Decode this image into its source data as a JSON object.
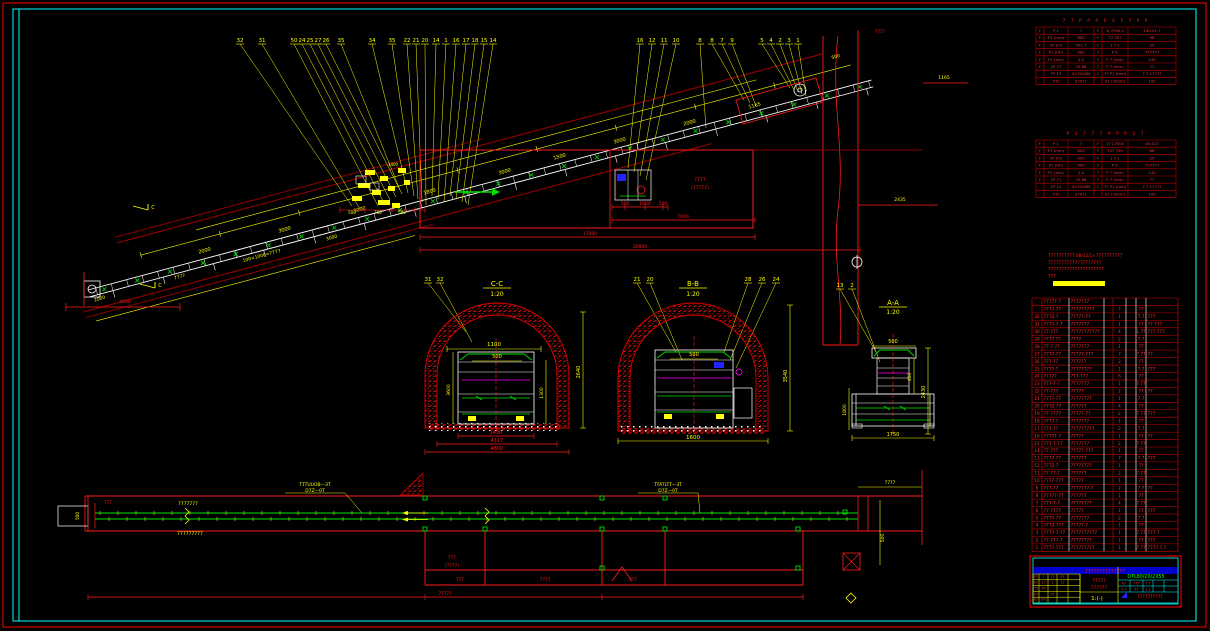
{
  "drawing": {
    "model": "DTL80/20/2X55",
    "type": "belt-conveyor-installation-drawing"
  },
  "elevation": {
    "callouts": [
      {
        "n": "32",
        "x": 240,
        "tx": 352,
        "ty": 206
      },
      {
        "n": "31",
        "x": 262,
        "tx": 360,
        "ty": 209
      },
      {
        "n": "50",
        "x": 294,
        "tx": 378,
        "ty": 206
      },
      {
        "n": "24",
        "x": 302,
        "tx": 384,
        "ty": 203
      },
      {
        "n": "25",
        "x": 310,
        "tx": 390,
        "ty": 200
      },
      {
        "n": "27",
        "x": 318,
        "tx": 396,
        "ty": 197
      },
      {
        "n": "26",
        "x": 326,
        "tx": 402,
        "ty": 194
      },
      {
        "n": "35",
        "x": 341,
        "tx": 400,
        "ty": 190
      },
      {
        "n": "34",
        "x": 372,
        "tx": 408,
        "ty": 193
      },
      {
        "n": "35",
        "x": 392,
        "tx": 414,
        "ty": 196
      },
      {
        "n": "22",
        "x": 407,
        "tx": 418,
        "ty": 199
      },
      {
        "n": "21",
        "x": 416,
        "tx": 422,
        "ty": 202
      },
      {
        "n": "20",
        "x": 425,
        "tx": 426,
        "ty": 205
      },
      {
        "n": "14",
        "x": 436,
        "tx": 432,
        "ty": 196
      },
      {
        "n": "1",
        "x": 446,
        "tx": 438,
        "ty": 199
      },
      {
        "n": "16",
        "x": 456,
        "tx": 444,
        "ty": 202
      },
      {
        "n": "17",
        "x": 466,
        "tx": 450,
        "ty": 196
      },
      {
        "n": "18",
        "x": 475,
        "tx": 456,
        "ty": 199
      },
      {
        "n": "15",
        "x": 484,
        "tx": 462,
        "ty": 202
      },
      {
        "n": "14",
        "x": 493,
        "tx": 468,
        "ty": 205
      },
      {
        "n": "16",
        "x": 640,
        "tx": 628,
        "ty": 168
      },
      {
        "n": "12",
        "x": 652,
        "tx": 634,
        "ty": 172
      },
      {
        "n": "11",
        "x": 664,
        "tx": 640,
        "ty": 176
      },
      {
        "n": "10",
        "x": 676,
        "tx": 646,
        "ty": 180
      },
      {
        "n": "8",
        "x": 700,
        "tx": 706,
        "ty": 128
      },
      {
        "n": "8",
        "x": 712,
        "tx": 744,
        "ty": 100
      },
      {
        "n": "7",
        "x": 722,
        "tx": 750,
        "ty": 103
      },
      {
        "n": "9",
        "x": 732,
        "tx": 756,
        "ty": 106
      },
      {
        "n": "5",
        "x": 762,
        "tx": 790,
        "ty": 88
      },
      {
        "n": "4",
        "x": 771,
        "tx": 794,
        "ty": 90
      },
      {
        "n": "2",
        "x": 780,
        "tx": 798,
        "ty": 92
      },
      {
        "n": "3",
        "x": 789,
        "tx": 802,
        "ty": 94
      },
      {
        "n": "1",
        "x": 798,
        "tx": 806,
        "ty": 96
      }
    ],
    "incline_dims": [
      {
        "t": "2000",
        "x": 205,
        "y": 252
      },
      {
        "t": "3000",
        "x": 285,
        "y": 231
      },
      {
        "t": "3000",
        "x": 360,
        "y": 211
      },
      {
        "t": "1800",
        "x": 430,
        "y": 193
      },
      {
        "t": "3000",
        "x": 505,
        "y": 173
      },
      {
        "t": "1500",
        "x": 560,
        "y": 158
      },
      {
        "t": "3000",
        "x": 620,
        "y": 142
      },
      {
        "t": "2000",
        "x": 690,
        "y": 124
      },
      {
        "t": "1165",
        "x": 755,
        "y": 107
      }
    ],
    "tail_dims": [
      {
        "t": "2000",
        "x": 100,
        "y": 300
      },
      {
        "t": "7777",
        "x": 180,
        "y": 278
      },
      {
        "t": "100×1000=7777",
        "x": 262,
        "y": 257
      },
      {
        "t": "3000",
        "x": 332,
        "y": 239
      }
    ],
    "cluster_dims": [
      {
        "t": "500",
        "x": 352,
        "y": 214
      },
      {
        "t": "700",
        "x": 378,
        "y": 214
      },
      {
        "t": "500",
        "x": 402,
        "y": 214
      },
      {
        "t": "1400",
        "x": 393,
        "y": 166
      }
    ],
    "red_dims": [
      {
        "t": "500",
        "x": 625,
        "y": 205
      },
      {
        "t": "1000",
        "x": 645,
        "y": 205
      },
      {
        "t": "500",
        "x": 663,
        "y": 205
      },
      {
        "t": "7000",
        "x": 683,
        "y": 218
      },
      {
        "t": "17000",
        "x": 590,
        "y": 235
      },
      {
        "t": "30000",
        "x": 640,
        "y": 248
      },
      {
        "t": "4000",
        "x": 125,
        "y": 303
      }
    ],
    "room_label": [
      "7777",
      "(77777)"
    ],
    "head_texts": {
      "t1": "1165",
      "t2": "2435",
      "t3": "7777",
      "t4": "500"
    },
    "cut_label": "C"
  },
  "sections": {
    "cc": {
      "title": "C-C",
      "scale": "1:20",
      "callouts": [
        {
          "n": "31",
          "x": 428,
          "tx": 466,
          "ty": 332
        },
        {
          "n": "32",
          "x": 440,
          "tx": 472,
          "ty": 342
        }
      ],
      "top_dim": "1100",
      "top_dim2": "500",
      "right_dim": "2640",
      "left_dim": "3600",
      "inner_dim": "1300",
      "bottom_dims": [
        "1430",
        "4117",
        "4800"
      ]
    },
    "bb": {
      "title": "B-B",
      "scale": "1:20",
      "callouts": [
        {
          "n": "21",
          "x": 637,
          "tx": 676,
          "ty": 352
        },
        {
          "n": "20",
          "x": 650,
          "tx": 682,
          "ty": 360
        },
        {
          "n": "28",
          "x": 748,
          "tx": 724,
          "ty": 352
        },
        {
          "n": "26",
          "x": 762,
          "tx": 730,
          "ty": 360
        },
        {
          "n": "24",
          "x": 776,
          "tx": 736,
          "ty": 368
        }
      ],
      "top_dim": "500",
      "bottom_dim": "1600",
      "right_dim": "3540"
    },
    "aa": {
      "title": "A-A",
      "scale": "1:20",
      "callouts": [
        {
          "n": "13",
          "x": 840,
          "tx": 876,
          "ty": 352
        },
        {
          "n": "2",
          "x": 852,
          "tx": 880,
          "ty": 362
        }
      ],
      "top_dim": "500",
      "right_dim": "2430",
      "inner_dim": "400",
      "left_dim": "1800",
      "bottom_dim": "1750"
    }
  },
  "plan": {
    "label_above": "7777777",
    "label_below": "777777777",
    "callout1": [
      "TTTUUOB—3T",
      "D7Z—0T"
    ],
    "callout2": [
      "TTATLTT—3T",
      "D7Z—0T"
    ],
    "room_label": [
      "777",
      "(7777)"
    ],
    "dim_texts": [
      {
        "t": "777",
        "x": 460,
        "y": 581
      },
      {
        "t": "7777",
        "x": 545,
        "y": 581
      },
      {
        "t": "777",
        "x": 633,
        "y": 581
      },
      {
        "t": "77777",
        "x": 445,
        "y": 595
      }
    ],
    "left_dim": "500",
    "left_text": "777",
    "right_dim": "500",
    "right_top_dim": "7777"
  },
  "spec_table_1": {
    "header": "7 7 P P P E 3 7 7 P P",
    "rows": [
      [
        "F",
        "P 1",
        "7",
        "F",
        "1J 7000-1",
        "100-01.7"
      ],
      [
        "F",
        "P1 (mm)",
        "800",
        "F",
        "77 307",
        "98"
      ],
      [
        "F",
        "1P (m)",
        "452.7",
        "F",
        "1 7 1",
        "25"
      ],
      [
        "F",
        "P1 (t/h)",
        "400",
        "7",
        "P E",
        "777777"
      ],
      [
        "F",
        "P1 (m/s)",
        "2.0",
        "7",
        "P 7 (mm)",
        "140"
      ],
      [
        "F",
        "1P (°)",
        "25.88",
        "7",
        "P 7 (mm)",
        "77"
      ],
      [
        "",
        "TP 13",
        "2×Y200M",
        "1",
        "77 P1 (mm)",
        "7 7 17777"
      ],
      [
        "",
        "-T71",
        "S7071",
        "",
        "21 (7/mm)",
        "100"
      ]
    ]
  },
  "spec_table_2": {
    "header": "P 3 7 7 7 P P P 3 7",
    "rows": [
      [
        "F",
        "P 1",
        "7",
        "F",
        "17 J-7000",
        "45-017"
      ],
      [
        "F",
        "P1 (mm)",
        "800",
        "F",
        "707 700",
        "88"
      ],
      [
        "F",
        "1P (m)",
        "320",
        "F",
        "1 7 1",
        "25"
      ],
      [
        "F",
        "P1 (t/h)",
        "400",
        "7",
        "P E",
        "777777"
      ],
      [
        "F",
        "P1 (m/s)",
        "2.0",
        "7",
        "P 7 (mm)",
        "140"
      ],
      [
        "F",
        "1P (°)",
        "25.88",
        "7",
        "P 7 (mm)",
        "77"
      ],
      [
        "",
        "TP 13",
        "2×Y200M",
        "1",
        "77 P1 (mm)",
        "7 7 17777"
      ],
      [
        "",
        "-T71",
        "S7071",
        "",
        "21 (7/mm)",
        "100"
      ]
    ]
  },
  "notes": {
    "lines": [
      "7777777777 0B/12/2×7777777777",
      "77777777777777777777",
      "777777777777777777777",
      "777"
    ]
  },
  "bom": {
    "rows": [
      [
        "",
        "77777-7",
        "7777777",
        "",
        "",
        "",
        "",
        ""
      ],
      [
        "",
        "7777-77",
        "777777777",
        "",
        "7",
        "",
        "77",
        ""
      ],
      [
        "32",
        "777Z-7",
        "77777-77",
        "",
        "1",
        "",
        "7.7",
        "777"
      ],
      [
        "31",
        "7777-7-7",
        "7777777",
        "",
        "1",
        "",
        "77",
        "77 777"
      ],
      [
        "30",
        "77-777",
        "77777777777",
        "",
        "4",
        "",
        "1.77",
        "777 777"
      ],
      [
        "29",
        "7777.77",
        "7777",
        "",
        "2",
        "",
        "7.7",
        ""
      ],
      [
        "28",
        "77-7-77",
        "7777777",
        "",
        "1",
        "",
        "77",
        ""
      ],
      [
        "27",
        "7777-77",
        "77777-777",
        "",
        "7",
        "",
        "7.77",
        "77"
      ],
      [
        "26",
        "777-77",
        "777777",
        "",
        "2",
        "",
        "77",
        ""
      ],
      [
        "25",
        "7777-7",
        "77777777",
        "",
        "1",
        "",
        "7.7",
        "777"
      ],
      [
        "24",
        "77777",
        "777-777",
        "",
        "6",
        "",
        "77",
        ""
      ],
      [
        "23",
        "777-7-7",
        "7777777",
        "",
        "1",
        "",
        "7.77",
        ""
      ],
      [
        "22",
        "77-777",
        "77777",
        "",
        "2",
        "",
        "77",
        "77"
      ],
      [
        "21",
        "7777-77",
        "77777777",
        "",
        "1",
        "",
        "7.7",
        ""
      ],
      [
        "20",
        "777Z-77",
        "777777",
        "",
        "4",
        "",
        "77",
        ""
      ],
      [
        "19",
        "77-7777",
        "77777-77",
        "",
        "2",
        "",
        "7.77",
        "777"
      ],
      [
        "18",
        "7777-7",
        "7777777",
        "",
        "1",
        "",
        "77",
        ""
      ],
      [
        "17",
        "777-77",
        "777777777",
        "",
        "2",
        "",
        "7.7",
        ""
      ],
      [
        "16",
        "77777-7",
        "77777",
        "",
        "1",
        "",
        "77",
        "77"
      ],
      [
        "15",
        "777-7-77",
        "7777777",
        "",
        "2",
        "",
        "7.77",
        ""
      ],
      [
        "14",
        "77-777",
        "77777-777",
        "",
        "1",
        "",
        "77",
        ""
      ],
      [
        "13",
        "7777-77",
        "777777",
        "",
        "7",
        "",
        "7.7",
        "777"
      ],
      [
        "12",
        "777Z-7",
        "77777777",
        "",
        "1",
        "",
        "77",
        ""
      ],
      [
        "11",
        "77-77-7",
        "777777",
        "",
        "2",
        "",
        "7.77",
        ""
      ],
      [
        "10",
        "7777-777",
        "77777",
        "",
        "1",
        "",
        "77",
        ""
      ],
      [
        "9",
        "777-77",
        "7777777-7",
        "",
        "2",
        "",
        "7.7",
        "77"
      ],
      [
        "8",
        "77777-77",
        "777777",
        "",
        "1",
        "",
        "77",
        ""
      ],
      [
        "7",
        "777-7-7",
        "77777777",
        "",
        "4",
        "",
        "7.77",
        ""
      ],
      [
        "6",
        "77-7777",
        "77777",
        "",
        "1",
        "",
        "77",
        "777"
      ],
      [
        "5",
        "7777-77",
        "7777777",
        "",
        "2",
        "",
        "7.7",
        ""
      ],
      [
        "4",
        "777Z-777",
        "77777-7",
        "",
        "1",
        "",
        "77",
        ""
      ],
      [
        "3",
        "7777-7-77",
        "7777777777",
        "",
        "1",
        "",
        "7.77",
        "777 7"
      ],
      [
        "2",
        "77-777-7",
        "77777777",
        "",
        "1",
        "",
        "77",
        "777"
      ],
      [
        "1",
        "7777-777",
        "777777777",
        "",
        "1",
        "",
        "7.77",
        "7777 7.7"
      ]
    ]
  },
  "titleblock": {
    "band": "77777777777777",
    "left_cells": [
      [
        "P7",
        "7",
        "77",
        "P7"
      ],
      [
        "P7",
        "77",
        "7",
        "77"
      ],
      [
        "77",
        "7P",
        "",
        ""
      ],
      [
        "P7",
        "",
        "77",
        ""
      ],
      [
        "P7",
        "7P7",
        "",
        ""
      ]
    ],
    "name_lines": [
      "77777",
      "777777"
    ],
    "scale": "1:(-)",
    "model": "DTL80/20/2X55",
    "right_cells": [
      [
        "P7",
        "777",
        "7 7"
      ],
      [
        "7-7",
        "77",
        "1:1"
      ]
    ],
    "serial": "7777777777"
  }
}
